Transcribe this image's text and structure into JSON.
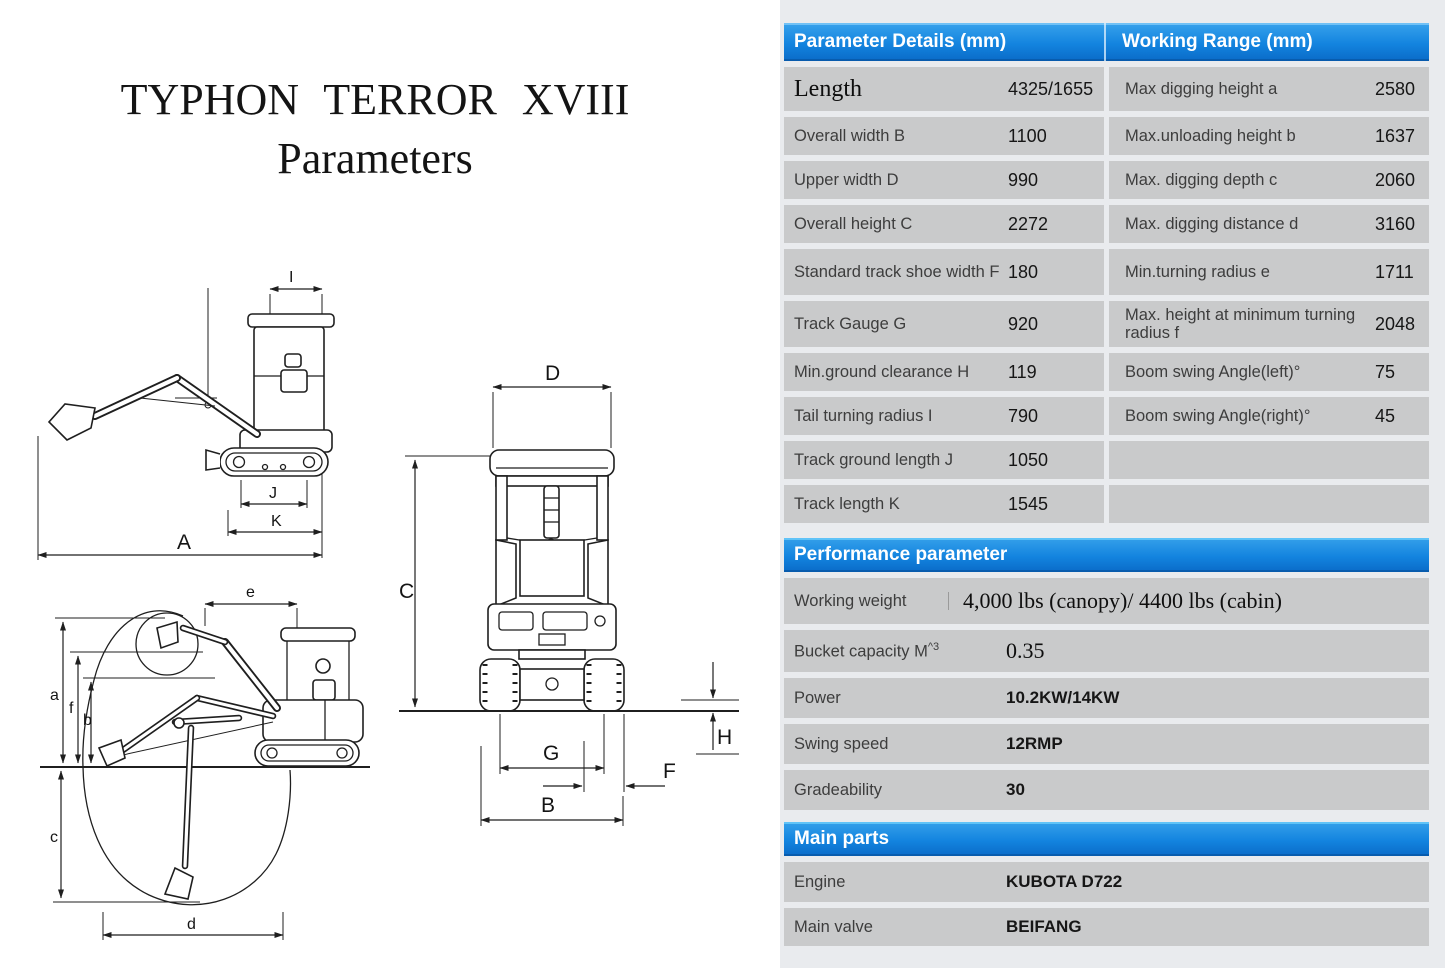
{
  "title": {
    "line1": "TYPHON TERROR XVIII",
    "line2": "Parameters"
  },
  "colors": {
    "header_blue": "#1384df",
    "row_gray": "#c9cacb",
    "panel_bg": "#e9ebee",
    "line_color": "#1f1f1f"
  },
  "spec_table": {
    "header_left": "Parameter Details (mm)",
    "header_right": "Working Range (mm)",
    "rows": [
      {
        "l_label": "Length",
        "l_value": "4325/1655",
        "r_label": "Max digging height a",
        "r_value": "2580"
      },
      {
        "l_label": "Overall width B",
        "l_value": "1100",
        "r_label": "Max.unloading height b",
        "r_value": "1637"
      },
      {
        "l_label": "Upper width D",
        "l_value": "990",
        "r_label": "Max. digging depth c",
        "r_value": "2060"
      },
      {
        "l_label": "Overall height C",
        "l_value": "2272",
        "r_label": "Max. digging distance d",
        "r_value": "3160"
      },
      {
        "l_label": "Standard track shoe width F",
        "l_value": "180",
        "r_label": "Min.turning radius e",
        "r_value": "1711"
      },
      {
        "l_label": "Track Gauge G",
        "l_value": "920",
        "r_label": "Max. height at minimum turning radius f",
        "r_value": "2048"
      },
      {
        "l_label": "Min.ground clearance H",
        "l_value": "119",
        "r_label": "Boom swing Angle(left)°",
        "r_value": "75"
      },
      {
        "l_label": "Tail turning radius I",
        "l_value": "790",
        "r_label": "Boom swing Angle(right)°",
        "r_value": "45"
      },
      {
        "l_label": "Track ground length J",
        "l_value": "1050",
        "r_label": "",
        "r_value": ""
      },
      {
        "l_label": "Track length K",
        "l_value": "1545",
        "r_label": "",
        "r_value": ""
      }
    ]
  },
  "performance": {
    "header": "Performance parameter",
    "rows": [
      {
        "label": "Working weight",
        "value": "4,000 lbs (canopy)/ 4400 lbs (cabin)"
      },
      {
        "label": "Bucket capacity M",
        "label_sup": "^3",
        "value": "0.35"
      },
      {
        "label": "Power",
        "value": "10.2KW/14KW"
      },
      {
        "label": "Swing speed",
        "value": "12RMP"
      },
      {
        "label": "Gradeability",
        "value": "30"
      }
    ]
  },
  "main_parts": {
    "header": "Main parts",
    "rows": [
      {
        "label": "Engine",
        "value": "KUBOTA D722"
      },
      {
        "label": "Main valve",
        "value": "BEIFANG"
      }
    ]
  },
  "diagrams": {
    "side_view": {
      "labels": {
        "i": "I",
        "j": "J",
        "k": "K",
        "a": "A"
      }
    },
    "front_view": {
      "labels": {
        "d": "D",
        "c": "C",
        "g": "G",
        "f": "F",
        "b": "B",
        "h": "H"
      }
    },
    "working_range": {
      "labels": {
        "e": "e",
        "a": "a",
        "f": "f",
        "b": "b",
        "c": "c",
        "d": "d"
      }
    }
  }
}
